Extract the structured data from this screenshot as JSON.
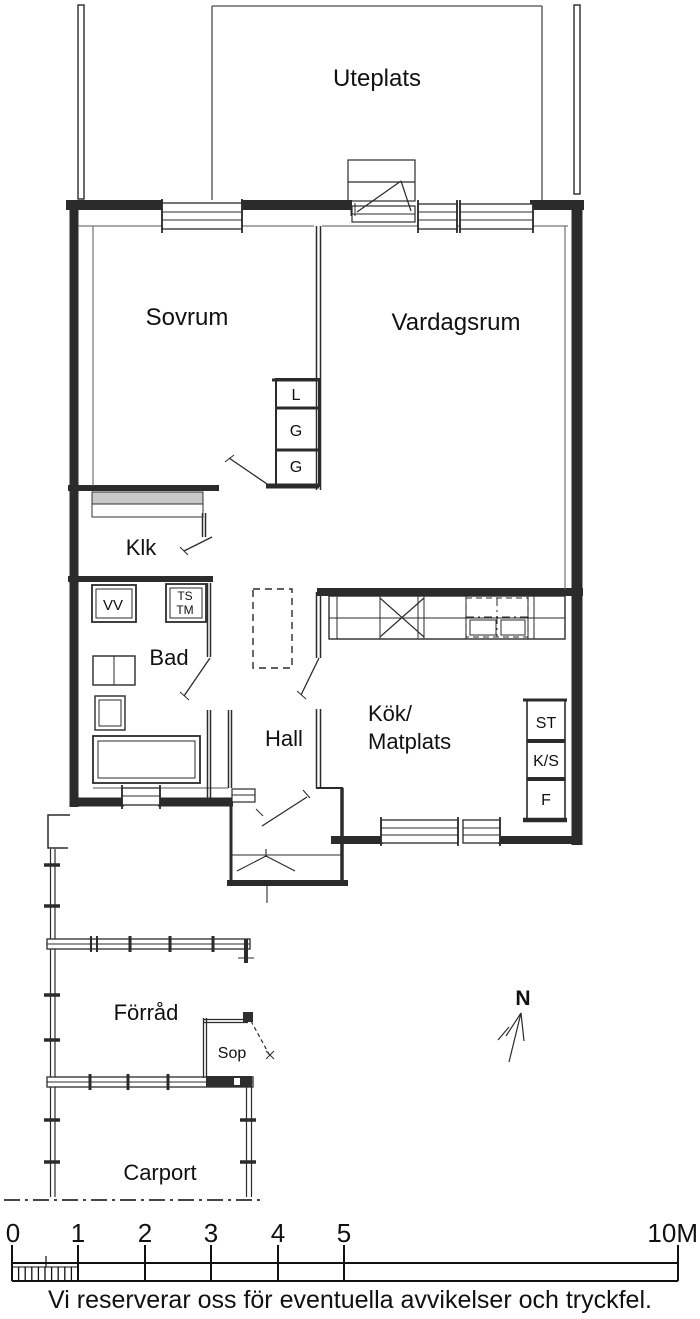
{
  "rooms": {
    "uteplats": "Uteplats",
    "sovrum": "Sovrum",
    "vardagsrum": "Vardagsrum",
    "klk": "Klk",
    "bad": "Bad",
    "hall": "Hall",
    "kok_line1": "Kök/",
    "kok_line2": "Matplats",
    "forrad": "Förråd",
    "sop": "Sop",
    "carport": "Carport"
  },
  "closet_labels": {
    "top": "L",
    "middle": "G",
    "bottom": "G"
  },
  "utility_labels": {
    "vv": "VV",
    "ts": "TS",
    "tm": "TM"
  },
  "kitchen_labels": {
    "st": "ST",
    "ks": "K/S",
    "f": "F"
  },
  "compass": {
    "label": "N"
  },
  "scale": {
    "ticks": [
      "0",
      "1",
      "2",
      "3",
      "4",
      "5"
    ],
    "end_label": "10M"
  },
  "footer": {
    "disclaimer": "Vi reserverar oss för eventuella avvikelser och tryckfel."
  },
  "colors": {
    "line": "#2b2b2b",
    "thin_line": "#4a4a4a",
    "background": "#ffffff"
  }
}
